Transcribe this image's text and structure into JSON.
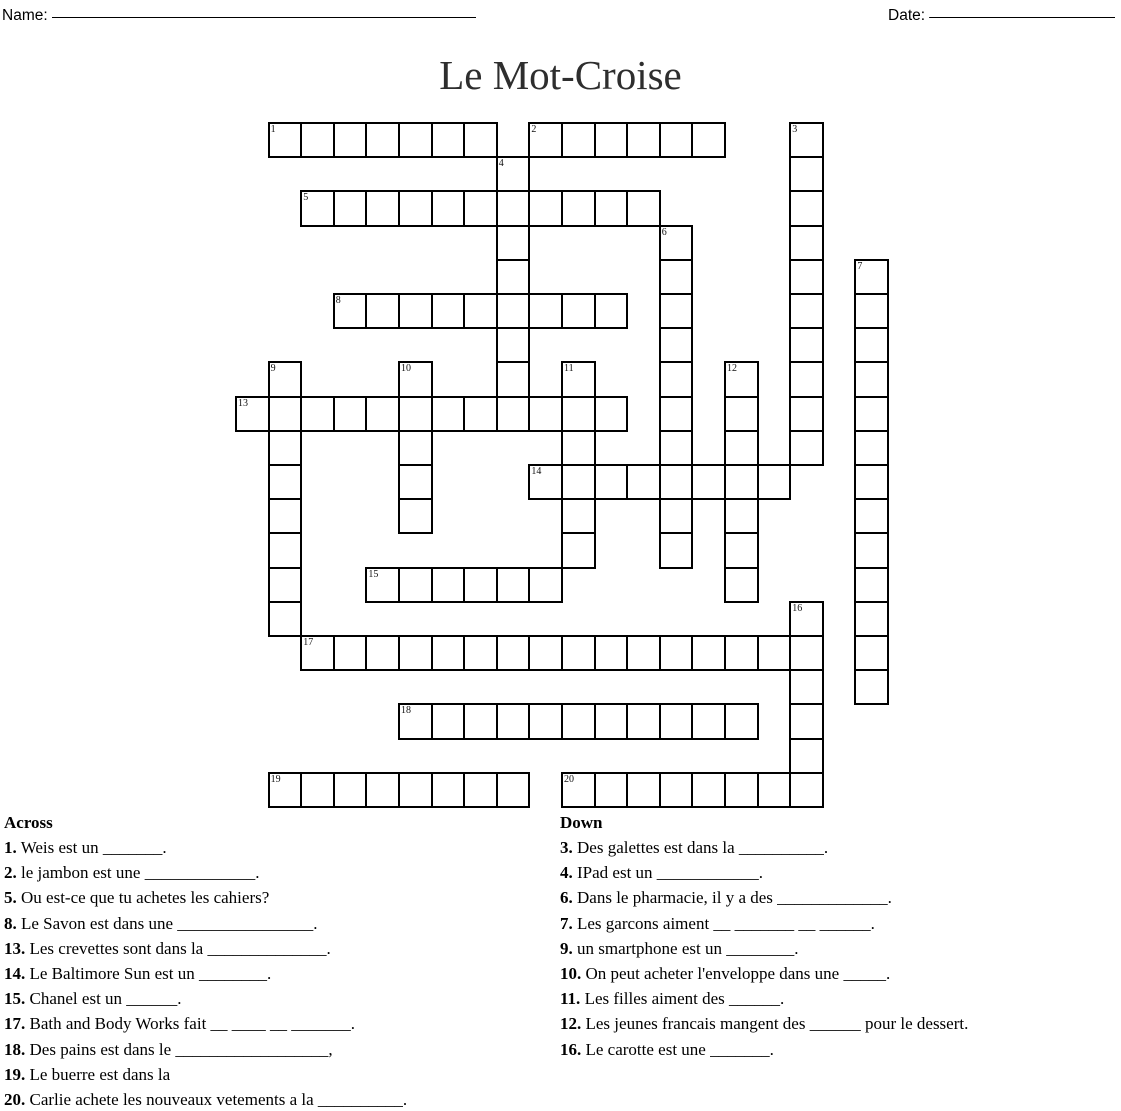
{
  "header": {
    "name_label": "Name:",
    "name_line": "_______________________________________________________",
    "date_label": "Date:",
    "date_line": "________________________"
  },
  "title": "Le Mot-Croise",
  "grid": {
    "origin_x": 235,
    "origin_y": 122,
    "cell_w": 32.6,
    "cell_h": 34.2,
    "rows": [
      {
        "r": 0,
        "cols": "1-7,9-14,17"
      },
      {
        "r": 1,
        "cols": "8,17"
      },
      {
        "r": 2,
        "cols": "2-12,17"
      },
      {
        "r": 3,
        "cols": "8,13,17"
      },
      {
        "r": 4,
        "cols": "8,13,17,19"
      },
      {
        "r": 5,
        "cols": "3-11,13,17,19"
      },
      {
        "r": 6,
        "cols": "8,13,17,19"
      },
      {
        "r": 7,
        "cols": "1,5,8,10,13,15,17,19"
      },
      {
        "r": 8,
        "cols": "0-11,13,15,17,19"
      },
      {
        "r": 9,
        "cols": "1,5,10,13,15,17,19"
      },
      {
        "r": 10,
        "cols": "1,5,9-16,19"
      },
      {
        "r": 11,
        "cols": "1,5,10,13,15,19"
      },
      {
        "r": 12,
        "cols": "1,10,13,15,19"
      },
      {
        "r": 13,
        "cols": "1,4-9,15,19"
      },
      {
        "r": 14,
        "cols": "1,17,19"
      },
      {
        "r": 15,
        "cols": "2-17,19"
      },
      {
        "r": 16,
        "cols": "17,19"
      },
      {
        "r": 17,
        "cols": "5-15,17"
      },
      {
        "r": 18,
        "cols": "17"
      },
      {
        "r": 19,
        "cols": "1-8,10-17"
      }
    ],
    "numbers": [
      {
        "n": "1",
        "r": 0,
        "c": 1
      },
      {
        "n": "2",
        "r": 0,
        "c": 9
      },
      {
        "n": "3",
        "r": 0,
        "c": 17
      },
      {
        "n": "4",
        "r": 1,
        "c": 8
      },
      {
        "n": "5",
        "r": 2,
        "c": 2
      },
      {
        "n": "6",
        "r": 3,
        "c": 13
      },
      {
        "n": "7",
        "r": 4,
        "c": 19
      },
      {
        "n": "8",
        "r": 5,
        "c": 3
      },
      {
        "n": "9",
        "r": 7,
        "c": 1
      },
      {
        "n": "10",
        "r": 7,
        "c": 5
      },
      {
        "n": "11",
        "r": 7,
        "c": 10
      },
      {
        "n": "12",
        "r": 7,
        "c": 15
      },
      {
        "n": "13",
        "r": 8,
        "c": 0
      },
      {
        "n": "14",
        "r": 10,
        "c": 9
      },
      {
        "n": "15",
        "r": 13,
        "c": 4
      },
      {
        "n": "16",
        "r": 14,
        "c": 17
      },
      {
        "n": "17",
        "r": 15,
        "c": 2
      },
      {
        "n": "18",
        "r": 17,
        "c": 5
      },
      {
        "n": "19",
        "r": 19,
        "c": 1
      },
      {
        "n": "20",
        "r": 19,
        "c": 10
      }
    ]
  },
  "clues": {
    "across_header": "Across",
    "down_header": "Down",
    "across": [
      {
        "n": "1",
        "text": "Weis est un _______."
      },
      {
        "n": "2",
        "text": "le jambon est une _____________."
      },
      {
        "n": "5",
        "text": "Ou est-ce que tu achetes les cahiers?"
      },
      {
        "n": "8",
        "text": "Le Savon est dans une ________________."
      },
      {
        "n": "13",
        "text": "Les crevettes sont dans la ______________."
      },
      {
        "n": "14",
        "text": "Le Baltimore Sun est un ________."
      },
      {
        "n": "15",
        "text": "Chanel est un ______."
      },
      {
        "n": "17",
        "text": "Bath and Body Works fait __ ____ __ _______."
      },
      {
        "n": "18",
        "text": "Des pains est dans le __________________,"
      },
      {
        "n": "19",
        "text": "Le buerre est dans la"
      },
      {
        "n": "20",
        "text": "Carlie achete les nouveaux vetements a la __________."
      }
    ],
    "down": [
      {
        "n": "3",
        "text": "Des galettes est dans la __________."
      },
      {
        "n": "4",
        "text": "IPad est un ____________."
      },
      {
        "n": "6",
        "text": "Dans le pharmacie, il y a des _____________."
      },
      {
        "n": "7",
        "text": "Les garcons aiment __ _______ __ ______."
      },
      {
        "n": "9",
        "text": "un smartphone est un ________."
      },
      {
        "n": "10",
        "text": "On peut acheter l'enveloppe dans une _____."
      },
      {
        "n": "11",
        "text": "Les filles aiment des ______."
      },
      {
        "n": "12",
        "text": "Les jeunes francais mangent des ______ pour le dessert."
      },
      {
        "n": "16",
        "text": "Le carotte est une _______."
      }
    ]
  }
}
